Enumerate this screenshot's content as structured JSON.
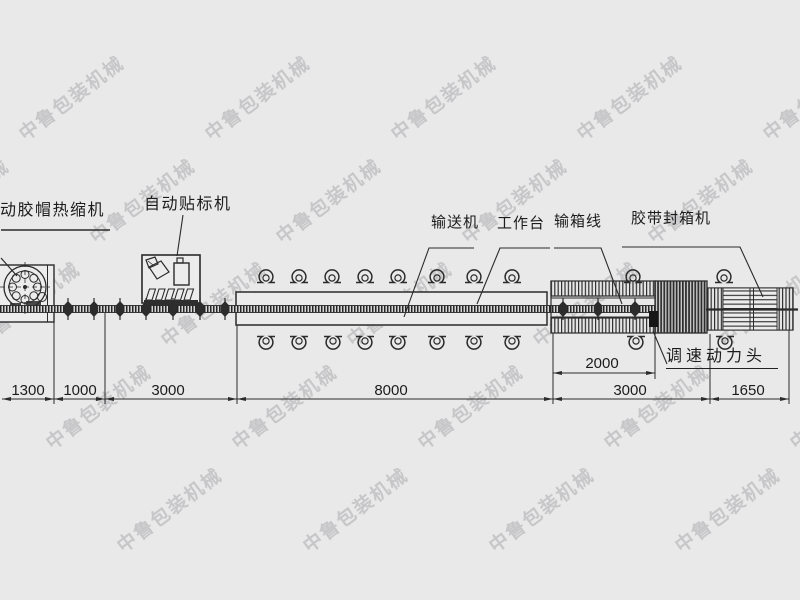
{
  "watermark": {
    "text": "中鲁包装机械",
    "color": "#c7c7c9",
    "angle_deg": -37,
    "row_y": [
      97,
      200,
      303,
      406,
      509
    ],
    "row_x0": [
      70,
      141,
      212,
      283,
      354
    ],
    "col_step": 186,
    "cols_from": -1,
    "cols_to": 4
  },
  "machine_labels": {
    "shrink": "动胶帽热缩机",
    "labeler": "自动贴标机",
    "conveyor": "输送机",
    "workbench": "工作台",
    "box_line": "输箱线",
    "sealer": "胶带封箱机",
    "power_head": "调速动力头"
  },
  "dimensions": [
    {
      "value": "1300",
      "x1": 2,
      "x2": 54,
      "y": 399
    },
    {
      "value": "1000",
      "x1": 54,
      "x2": 105,
      "y": 399
    },
    {
      "value": "3000",
      "x1": 105,
      "x2": 237,
      "y": 399
    },
    {
      "value": "8000",
      "x1": 237,
      "x2": 553,
      "y": 399
    },
    {
      "value": "3000",
      "x1": 553,
      "x2": 710,
      "y": 399
    },
    {
      "value": "1650",
      "x1": 710,
      "x2": 789,
      "y": 399
    },
    {
      "value": "2000",
      "x1": 553,
      "x2": 655,
      "y": 373
    }
  ],
  "diagram": {
    "omega_top_y": 277,
    "omega_top_x": [
      266,
      299,
      332,
      365,
      398,
      437,
      474,
      512,
      633,
      724
    ],
    "omega_bottom_y": 342,
    "omega_bottom_x": [
      266,
      299,
      333,
      365,
      398,
      437,
      474,
      512,
      636,
      725
    ],
    "spindle_y": 309,
    "spindle_x": [
      68,
      94,
      120,
      146,
      173,
      200,
      225,
      563,
      598,
      635
    ]
  },
  "colors": {
    "background": "#e9e9e9",
    "line": "#2b2b2b",
    "panel": "#ebebeb"
  }
}
